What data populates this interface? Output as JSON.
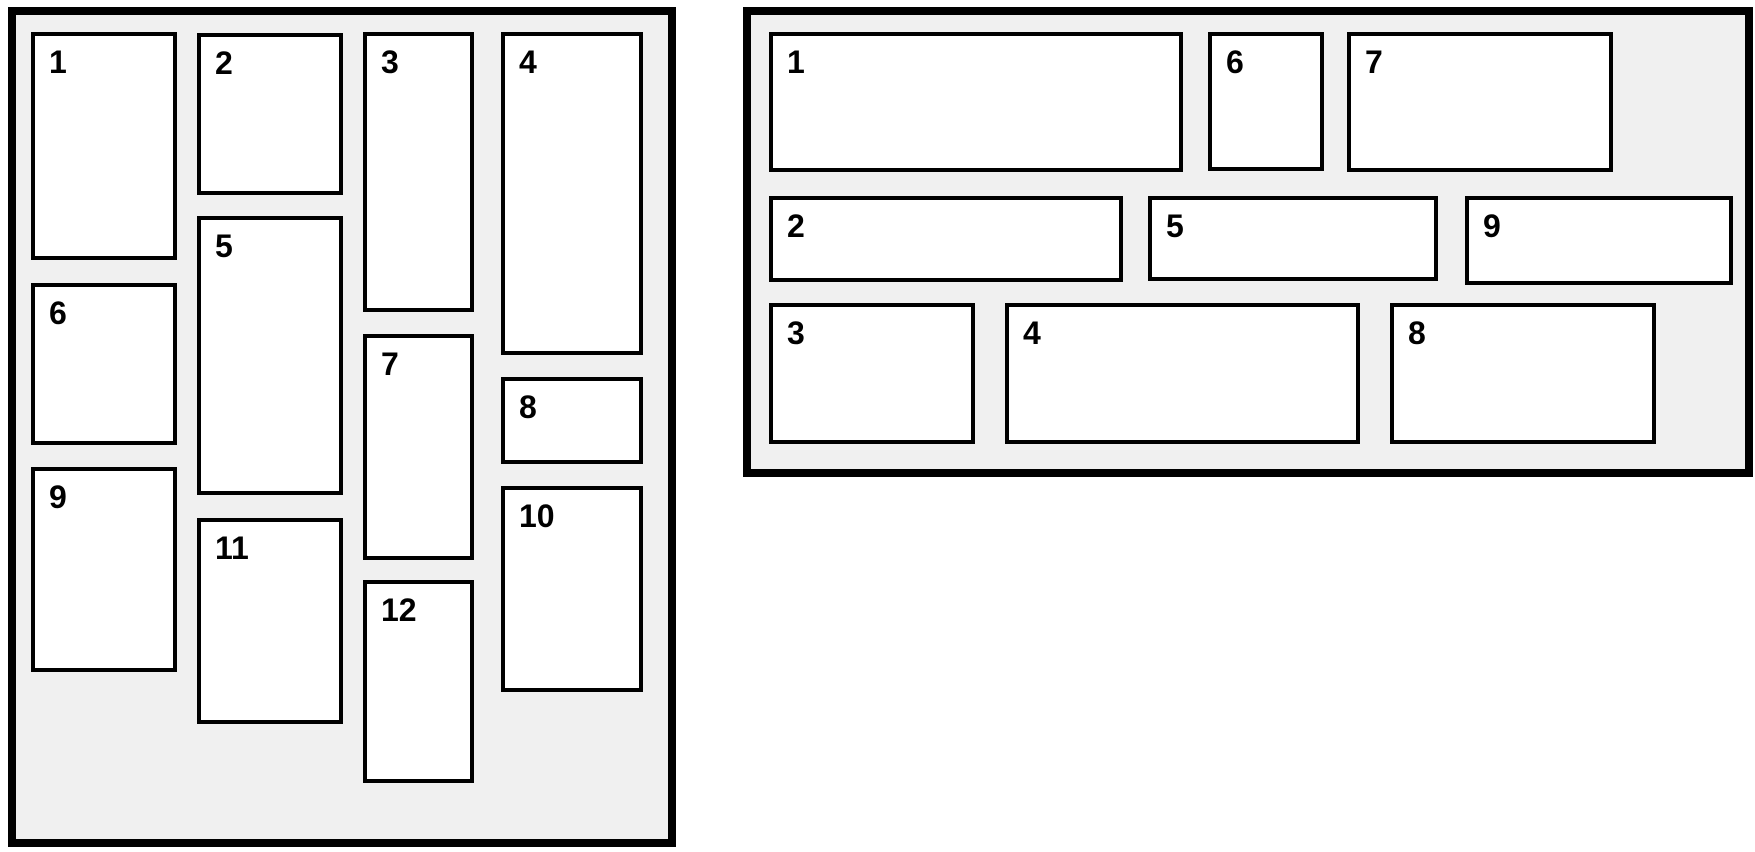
{
  "colors": {
    "page_background": "#ffffff",
    "panel_background": "#f0f0f0",
    "tile_background": "#ffffff",
    "border": "#000000"
  },
  "left_panel": {
    "items": [
      "1",
      "2",
      "3",
      "4",
      "5",
      "6",
      "7",
      "8",
      "9",
      "10",
      "11",
      "12"
    ]
  },
  "right_panel": {
    "items": [
      "1",
      "2",
      "3",
      "4",
      "5",
      "6",
      "7",
      "8",
      "9"
    ]
  }
}
